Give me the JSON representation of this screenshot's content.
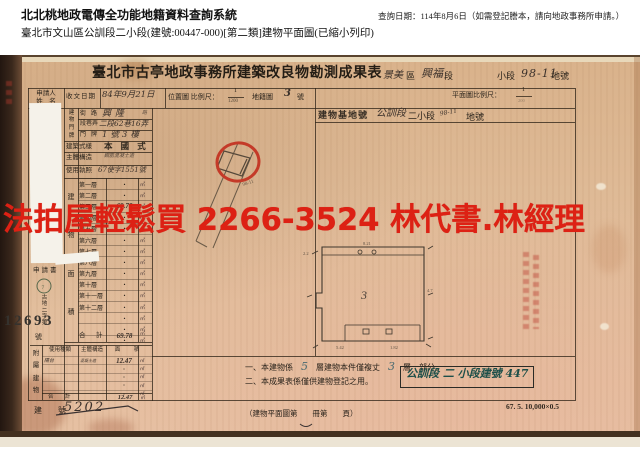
{
  "header": {
    "system_title": "北北桃地政電傳全功能地籍資料查詢系統",
    "query_date_line": "查詢日期：114年8月6日（如需登記謄本，請向地政事務所申請。）",
    "document_line": "臺北市文山區公訓段二小段(建號:00447-000)[第二類]建物平面圖(已縮小列印)"
  },
  "watermark": {
    "text": "法拍屋輕鬆買 2266-3524 林代書.林經理",
    "color": "#dd2114"
  },
  "document": {
    "title": "臺北市古亭地政事務所建築改良物勘測成果表",
    "title_annotation": {
      "district_value": "景美",
      "district_suffix": "區",
      "section_value": "興福",
      "section_suffix": "段",
      "subsection_label": "小段",
      "parcel_value": "98-11",
      "parcel_suffix": "地號"
    },
    "fields": {
      "applicant_label_1": "申請人",
      "applicant_label_2": "姓　名",
      "receive_date_label": "收文日期",
      "receive_date_value": "84年9月21日",
      "location_scale_label": "位置圖 比例尺：",
      "location_scale_num": "1",
      "location_scale_den": "1200",
      "cadastre_label": "地籍圖",
      "cadastre_value": "3",
      "cadastre_unit": "號",
      "plan_scale_label": "平面圖比例尺：",
      "plan_scale_num": "1",
      "plan_scale_den": "200",
      "site_label": "建物基地號",
      "site_value_1": "公訓段",
      "site_value_2": "二小段",
      "site_scribble": "98-11",
      "site_suffix": "地號",
      "door_label_chars": "建物門牌",
      "street_label": "街路",
      "street_value": "興隆",
      "street_value_suffix": "路",
      "lane_label": "段巷弄",
      "lane_value": "二段62巷16弄",
      "door_no_label": "門牌",
      "door_no_value": "1號3樓",
      "style_label": "建築式樣",
      "style_value": "本 國 式",
      "structure_label": "主體構造",
      "structure_value": "鋼筋混凝土造",
      "license_label": "使用執照",
      "license_value": "67使字1551號",
      "area_label_chars": "建物面積"
    },
    "floors": {
      "unit": "㎡",
      "rows": [
        {
          "label": "第一層",
          "value": "・"
        },
        {
          "label": "第二層",
          "value": "・"
        },
        {
          "label": "第三層",
          "value": "69.78"
        },
        {
          "label": "第四層",
          "value": "・"
        },
        {
          "label": "第五層",
          "value": "・"
        },
        {
          "label": "第六層",
          "value": "・"
        },
        {
          "label": "第七層",
          "value": "・"
        },
        {
          "label": "第八層",
          "value": "・"
        },
        {
          "label": "第九層",
          "value": "・"
        },
        {
          "label": "第十層",
          "value": "・"
        },
        {
          "label": "第十一層",
          "value": "・"
        },
        {
          "label": "第十二層",
          "value": "・"
        },
        {
          "label": "",
          "value": "・"
        },
        {
          "label": "",
          "value": "・"
        },
        {
          "label": "",
          "value": "・"
        }
      ],
      "total_label": "合　計",
      "total_value": "69.78"
    },
    "receipt": {
      "doc_label": "申請書",
      "stamp_char": "7",
      "number_prefix_vertical": "古地二字第",
      "number": "12693",
      "number_suffix": "號"
    },
    "annex": {
      "block_label": "附屬建物",
      "headers": {
        "use": "使用種類",
        "structure": "主體構造",
        "area": "面　積"
      },
      "unit": "㎡",
      "rows": [
        {
          "use": "陽台",
          "structure": "混凝土造",
          "area": "12.47"
        },
        {
          "use": "",
          "structure": "",
          "area": "・"
        },
        {
          "use": "",
          "structure": "",
          "area": "・"
        },
        {
          "use": "",
          "structure": "",
          "area": "・"
        },
        {
          "use": "",
          "structure": "",
          "area": "・"
        }
      ],
      "total_label": "合　計",
      "total_value": "12.47"
    },
    "sketch": {
      "parcel_label": "98-11"
    },
    "plan": {
      "floor_mark": "3",
      "dim_top": "8.21",
      "dim_right": "4.7",
      "dim_left": "2.2",
      "dim_bottom_left": "5.42",
      "dim_bottom_right": "1.82"
    },
    "notes": {
      "note1_prefix": "一、本建物係",
      "note1_num1": "5",
      "note1_mid": "層建物本件僅複丈",
      "note1_num2": "3",
      "note1_suffix": "層　部分。",
      "note2": "二、本成果表係僅供建物登記之用。",
      "bottom_center": "（建物平面圖第　　冊第　　頁）",
      "building_no_label": "建　號",
      "building_no_value": "5202",
      "box_value": "公訓段 二 小段建號 447",
      "print_code": "67. 5. 10,000×0.5"
    }
  }
}
